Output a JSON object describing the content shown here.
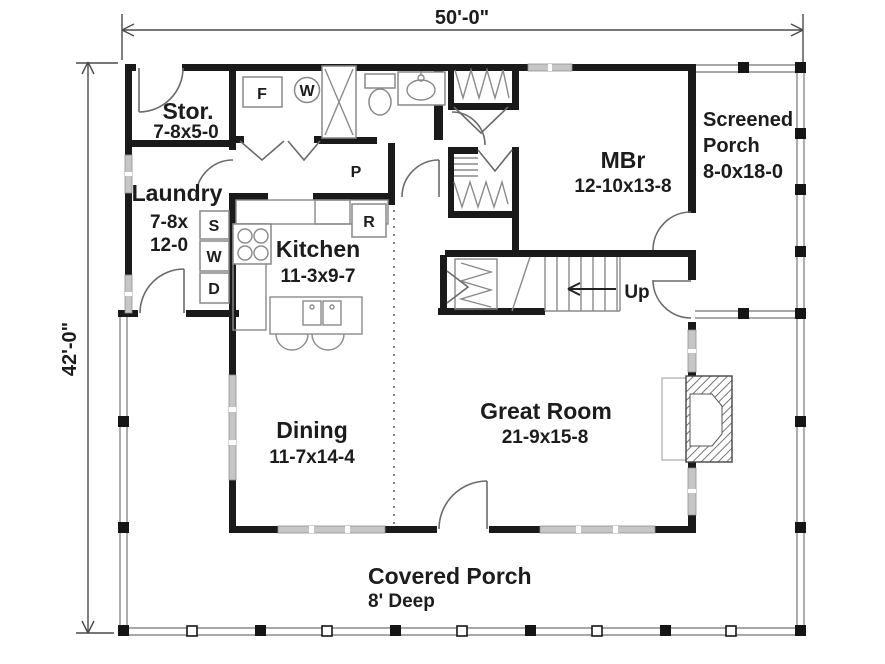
{
  "plan": {
    "type": "single-level house floor plan",
    "overall_width": "50'-0\"",
    "overall_depth": "42'-0\""
  },
  "rooms": {
    "stor": {
      "name": "Stor.",
      "size": "7-8x5-0"
    },
    "laundry": {
      "name": "Laundry",
      "size1": "7-8x",
      "size2": "12-0"
    },
    "kitchen": {
      "name": "Kitchen",
      "size": "11-3x9-7"
    },
    "dining": {
      "name": "Dining",
      "size": "11-7x14-4"
    },
    "great_room": {
      "name": "Great Room",
      "size": "21-9x15-8"
    },
    "mbr": {
      "name": "MBr",
      "size": "12-10x13-8"
    },
    "screened_porch": {
      "name1": "Screened",
      "name2": "Porch",
      "size": "8-0x18-0"
    },
    "covered_porch": {
      "name": "Covered Porch",
      "size": "8' Deep"
    }
  },
  "fixtures": {
    "freezer": "F",
    "water_heater": "W",
    "pantry": "P",
    "refrigerator": "R",
    "laundry_sink": "S",
    "washer": "W",
    "dryer": "D",
    "stairs_direction": "Up"
  },
  "colors": {
    "wall": "#1a1a1a",
    "window": "#c6c6c6",
    "line": "#8a8a8a",
    "text": "#1c1c1c",
    "background": "#ffffff"
  }
}
